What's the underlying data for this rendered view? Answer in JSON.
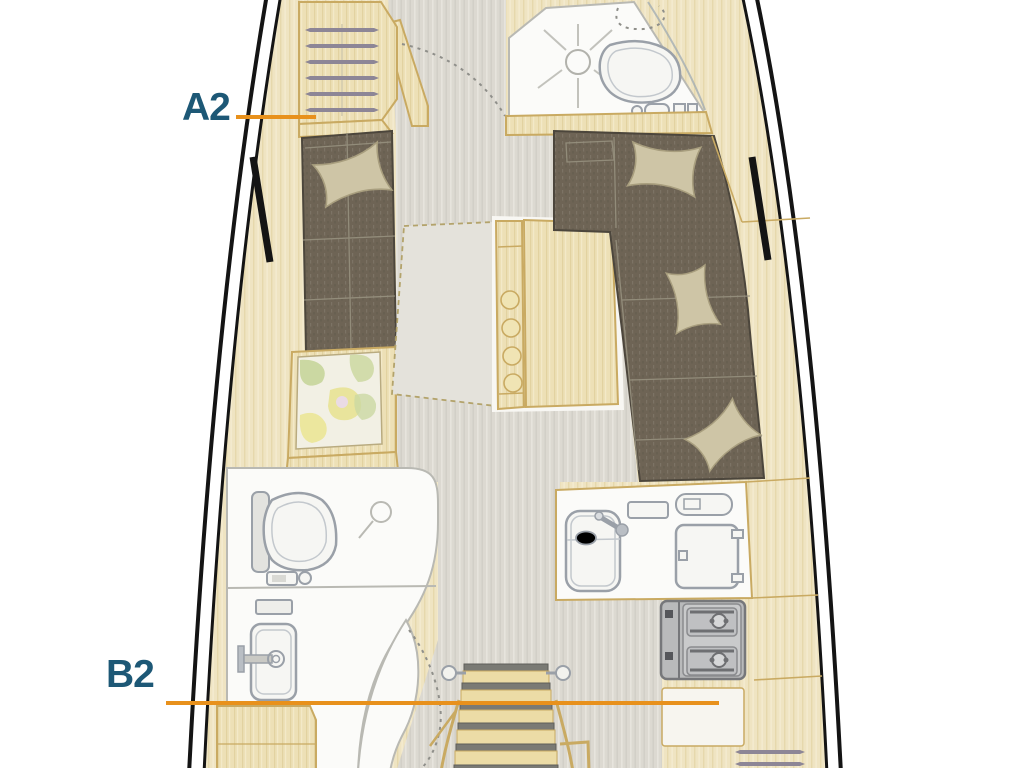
{
  "title": "Sailboat interior layout plan",
  "callouts": [
    {
      "id": "a2",
      "text": "A2"
    },
    {
      "id": "b2",
      "text": "B2"
    }
  ],
  "palette": {
    "label-blue": "#1D5876",
    "accent-orange": "#E8911C",
    "hull-black": "#141414",
    "wood-tan": "#EDE0B6",
    "deck-tan": "#EFE4C2",
    "wood-line": "#C9AA62",
    "floor-gray": "#DCD9D1",
    "cushion-brown": "#6E6455",
    "pillow-tan": "#CEC5A6",
    "fixture-white": "#FBFBF9",
    "fixture-line": "#9AA0A8",
    "stove-gray": "#B9BABB",
    "chart-green": "#CBD8A2",
    "chart-yellow": "#E9E49C"
  },
  "fixtures": [
    "hull-outline",
    "bow-shelf-locker",
    "forward-head-shower",
    "forward-head-toilet",
    "port-settee",
    "starboard-l-settee",
    "settee-pillows",
    "salon-table",
    "nav-chart-table",
    "aft-head-toilet",
    "aft-head-sink",
    "galley-counter",
    "galley-sink",
    "galley-fridge",
    "galley-stove",
    "companionway-steps",
    "door-swing-arcs",
    "hull-portlights"
  ]
}
